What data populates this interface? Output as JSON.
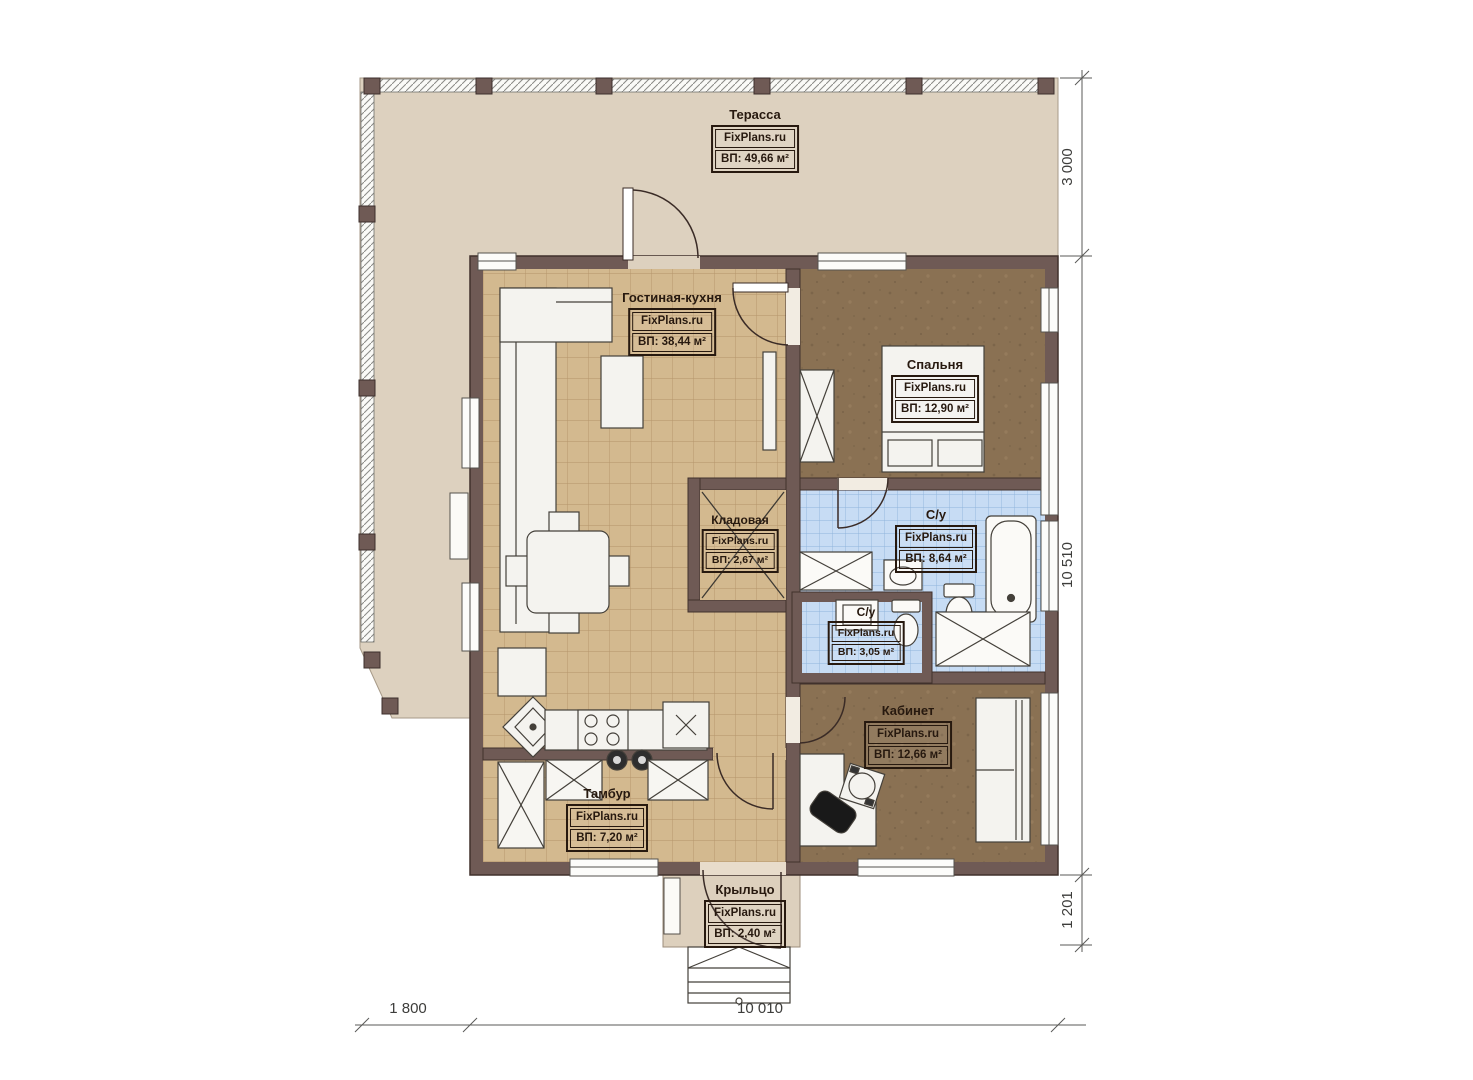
{
  "plan": {
    "site": "FixPlans.ru",
    "rooms": [
      {
        "id": "terrace",
        "name": "Терасса",
        "area": "ВП: 49,66 м²"
      },
      {
        "id": "living_kitchen",
        "name": "Гостиная-кухня",
        "area": "ВП: 38,44 м²"
      },
      {
        "id": "bedroom",
        "name": "Спальня",
        "area": "ВП: 12,90 м²"
      },
      {
        "id": "storage",
        "name": "Кладовая",
        "area": "ВП: 2,67 м²"
      },
      {
        "id": "bathroom",
        "name": "С/у",
        "area": "ВП: 8,64 м²"
      },
      {
        "id": "wc",
        "name": "С/у",
        "area": "ВП: 3,05 м²"
      },
      {
        "id": "office",
        "name": "Кабинет",
        "area": "ВП: 12,66 м²"
      },
      {
        "id": "vestibule",
        "name": "Тамбур",
        "area": "ВП: 7,20 м²"
      },
      {
        "id": "porch",
        "name": "Крыльцо",
        "area": "ВП: 2,40 м²"
      }
    ],
    "dimensions": {
      "terrace_depth": "3 000",
      "house_depth": "10 510",
      "porch_depth": "1 201",
      "terrace_overhang": "1 800",
      "house_width": "10 010"
    },
    "colors": {
      "wall": "#6f5a55",
      "tile_floor": "#d3b98f",
      "wood_floor": "#8a7153",
      "bath_floor": "#c7dcf4",
      "terrace_floor": "#ddd1bf",
      "label_ink": "#27190f"
    }
  }
}
